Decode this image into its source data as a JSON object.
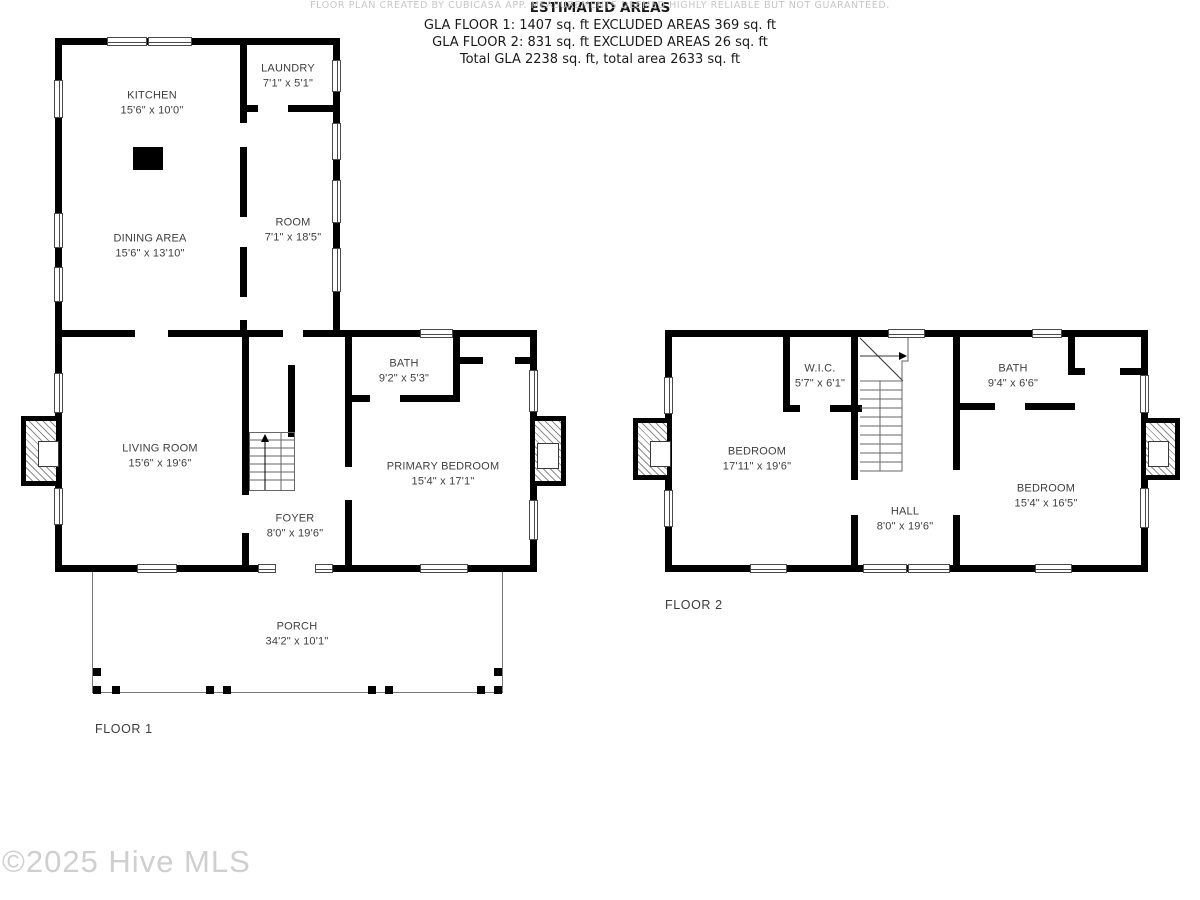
{
  "watermark": "©2025 Hive MLS",
  "disclaimer": "FLOOR PLAN CREATED BY CUBICASA APP. MEASUREMENTS DEEMED HIGHLY RELIABLE BUT NOT GUARANTEED.",
  "summary": {
    "title": "ESTIMATED AREAS",
    "lines": [
      "GLA FLOOR 1: 1407 sq. ft EXCLUDED AREAS 369 sq. ft",
      "GLA FLOOR 2: 831 sq. ft EXCLUDED AREAS 26 sq. ft",
      "Total GLA 2238 sq. ft, total area 2633 sq. ft"
    ]
  },
  "floor1": {
    "label": "FLOOR 1",
    "rooms": [
      {
        "name": "KITCHEN",
        "dims": "15'6\" x 10'0\""
      },
      {
        "name": "LAUNDRY",
        "dims": "7'1\" x 5'1\""
      },
      {
        "name": "DINING AREA",
        "dims": "15'6\" x 13'10\""
      },
      {
        "name": "ROOM",
        "dims": "7'1\" x 18'5\""
      },
      {
        "name": "BATH",
        "dims": "9'2\" x 5'3\""
      },
      {
        "name": "LIVING ROOM",
        "dims": "15'6\" x 19'6\""
      },
      {
        "name": "PRIMARY BEDROOM",
        "dims": "15'4\" x 17'1\""
      },
      {
        "name": "FOYER",
        "dims": "8'0\" x 19'6\""
      },
      {
        "name": "PORCH",
        "dims": "34'2\" x 10'1\""
      }
    ]
  },
  "floor2": {
    "label": "FLOOR 2",
    "rooms": [
      {
        "name": "BEDROOM",
        "dims": "17'11\" x 19'6\""
      },
      {
        "name": "W.I.C.",
        "dims": "5'7\" x 6'1\""
      },
      {
        "name": "BATH",
        "dims": "9'4\" x 6'6\""
      },
      {
        "name": "BEDROOM",
        "dims": "15'4\" x 16'5\""
      },
      {
        "name": "HALL",
        "dims": "8'0\" x 19'6\""
      }
    ]
  },
  "colors": {
    "wall": "#000000",
    "label": "#3f3f3f",
    "muted": "#c6c6c6",
    "watermark": "#cfcfcf"
  }
}
